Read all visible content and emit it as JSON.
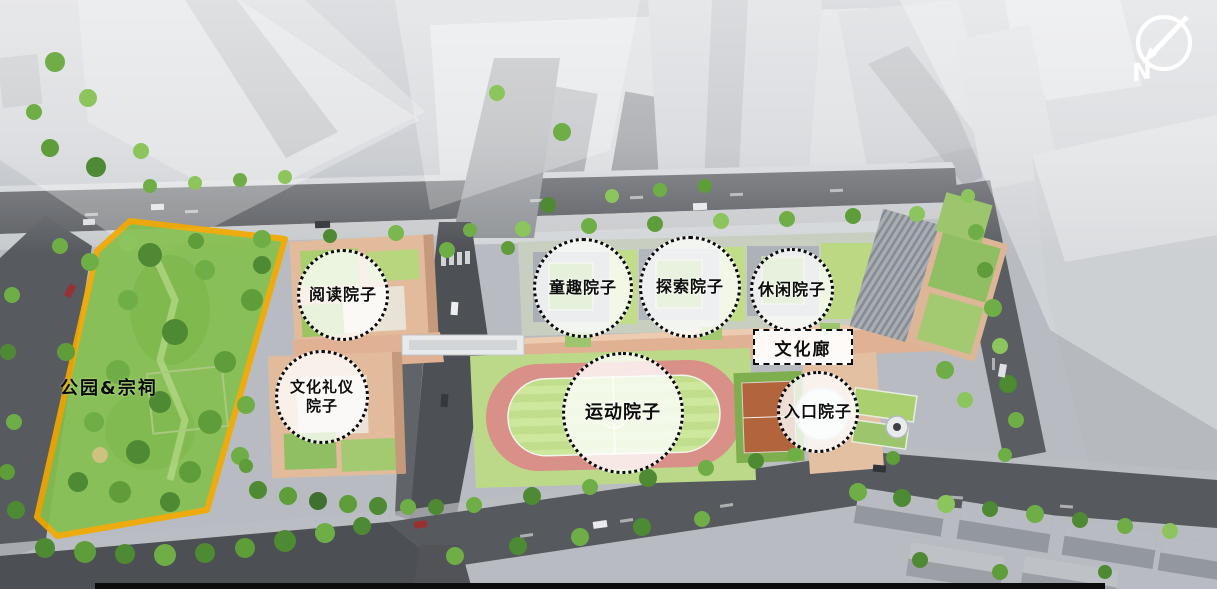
{
  "compass": {
    "north_label": "N"
  },
  "zones": {
    "park": {
      "label": "公园&宗祠"
    },
    "reading": {
      "label": "阅读院子"
    },
    "childhood_fun": {
      "label": "童趣院子"
    },
    "exploration": {
      "label": "探索院子"
    },
    "leisure": {
      "label": "休闲院子"
    },
    "culture_corridor": {
      "label": "文化廊"
    },
    "culture_etiquette": {
      "label": "文化礼仪\n院子"
    },
    "sports": {
      "label": "运动院子"
    },
    "entrance": {
      "label": "入口院子"
    }
  },
  "colors": {
    "park_fill": "#85BF4F",
    "park_outline": "#F2A900",
    "callout_border": "#0B0B0B",
    "campus_building": "#E2BB9C",
    "track_ring": "#D89089",
    "tennis_court": "#B2653C"
  }
}
